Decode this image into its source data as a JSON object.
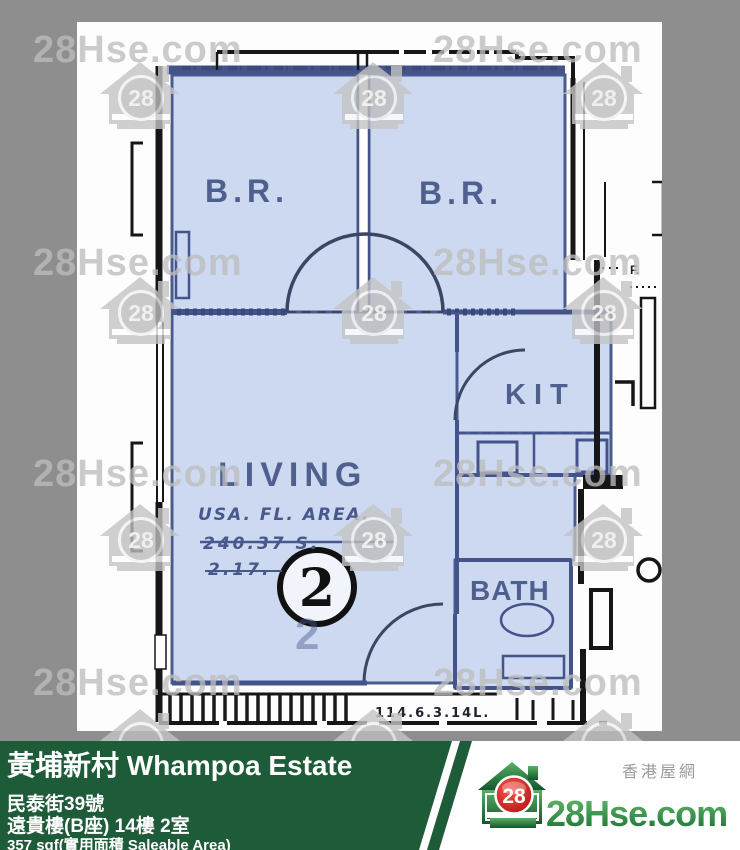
{
  "watermark": {
    "text": "28Hse.com",
    "number": "28"
  },
  "plan": {
    "rooms": {
      "bedroom1": "B.R.",
      "bedroom2": "B.R.",
      "living": "LIVING",
      "kitchen": "KIT",
      "bathroom": "BATH"
    },
    "unit_number": "2",
    "unit_number_shadow": "2",
    "annotations": {
      "area_line1": "USA. FL. AREA.",
      "area_line2": "240.37 S.",
      "area_line3": "2.17.",
      "bottom_dimension": "114.6.3.14L.",
      "flat_mark": "F."
    }
  },
  "footer": {
    "title": "黃埔新村 Whampoa Estate",
    "address": "民泰街39號",
    "block_floor_flat": "遠貴樓(B座) 14樓 2室",
    "area": "357 sqf(實用面積 Saleable Area)"
  },
  "brand": {
    "site_name": "28Hse.com",
    "tagline": "香港屋網",
    "logo_number": "28"
  },
  "colors": {
    "green_panel": "#1d5b39",
    "brand_green_light": "#6abf6e",
    "brand_green_dark": "#157031",
    "brand_red": "#c01210",
    "room_fill": "#cdd9f1",
    "wall_navy": "#44548a",
    "border_gray": "#8e8e8e",
    "watermark_gray": "#bcbcbc"
  }
}
